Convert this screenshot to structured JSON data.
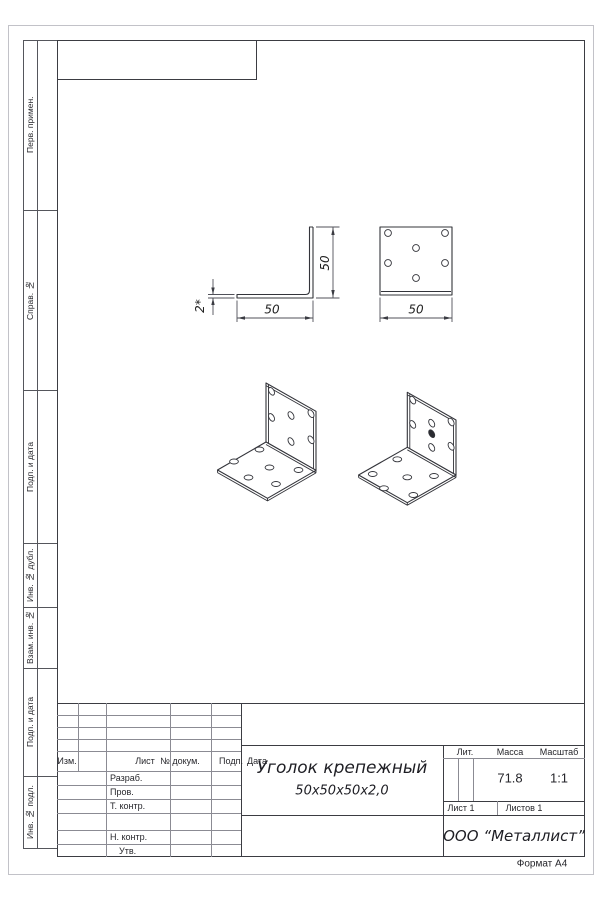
{
  "sidebar": {
    "labels": [
      "Перв. примен.",
      "Справ. №",
      "Подп. и дата",
      "Инв. № дубл.",
      "Взам. инв. №",
      "Подп. и дата",
      "Инв. № подл."
    ]
  },
  "drawing": {
    "dim_height": "50",
    "dim_width": "50",
    "dim_thickness": "2*",
    "dim_top_width": "50"
  },
  "title_block": {
    "col_izm": "Изм.",
    "col_list": "Лист",
    "col_doc": "№ докум.",
    "col_podp": "Подп.",
    "col_data": "Дата",
    "row_razrab": "Разраб.",
    "row_prov": "Пров.",
    "row_tkontr": "Т. контр.",
    "row_nkontr": "Н. контр.",
    "row_utv": "Утв.",
    "name_line1": "Уголок крепежный",
    "name_line2": "50х50х50х2,0",
    "lit_label": "Лит.",
    "mass_label": "Масса",
    "scale_label": "Масштаб",
    "mass_value": "71.8",
    "scale_value": "1:1",
    "sheet_label": "Лист 1",
    "sheets_label": "Листов 1",
    "company": "ООО “Металлист”"
  },
  "footer": {
    "format_label": "Формат А4"
  }
}
